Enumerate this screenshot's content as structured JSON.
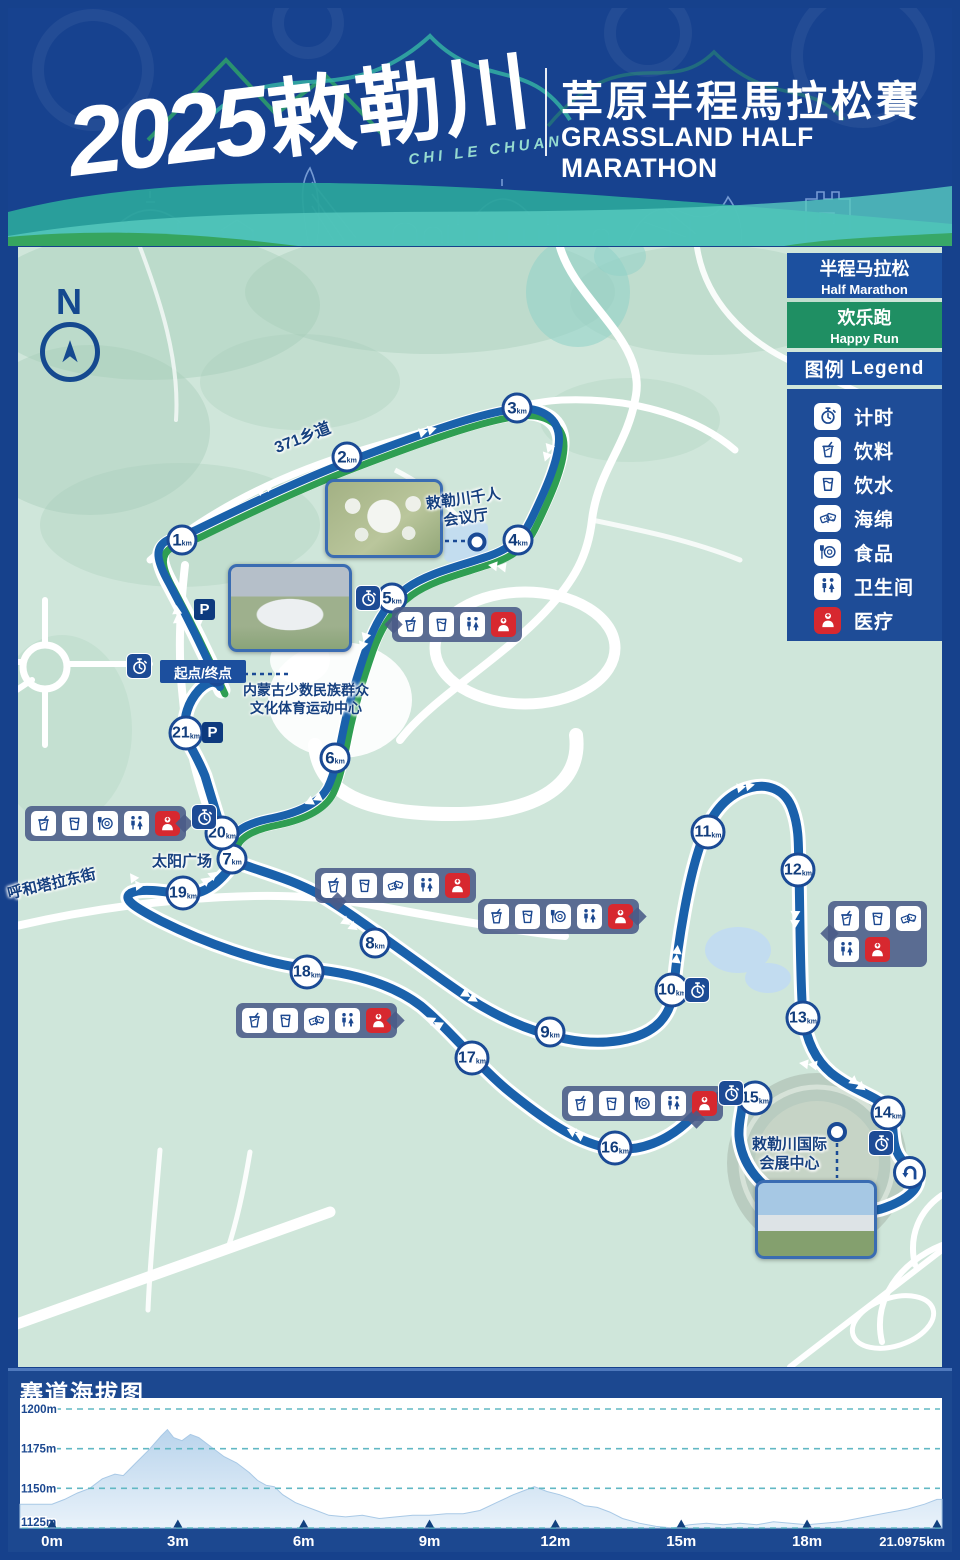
{
  "header": {
    "logo_year": "2025",
    "logo_cn": "敕勒川",
    "logo_pinyin": "CHI LE CHUAN",
    "title_cn": "草原半程馬拉松賽",
    "title_en": "GRASSLAND HALF MARATHON"
  },
  "map": {
    "compass": "N",
    "km_unit": "km",
    "parking_label": "P",
    "start_finish": "起点/终点",
    "routes": {
      "half_marathon_color": "#1a61ab",
      "happy_run_color": "#2f9e52"
    },
    "legend": {
      "half_marathon": {
        "zh": "半程马拉松",
        "en": "Half Marathon",
        "color": "#1c509f"
      },
      "happy_run": {
        "zh": "欢乐跑",
        "en": "Happy Run",
        "color": "#1f8f63"
      },
      "title_zh": "图例",
      "title_en": "Legend",
      "medical_color": "#d7282f",
      "items": [
        {
          "icon": "timer-icon",
          "label": "计时"
        },
        {
          "icon": "drink-icon",
          "label": "饮料"
        },
        {
          "icon": "water-icon",
          "label": "饮水"
        },
        {
          "icon": "sponge-icon",
          "label": "海绵"
        },
        {
          "icon": "food-icon",
          "label": "食品"
        },
        {
          "icon": "toilet-icon",
          "label": "卫生间"
        },
        {
          "icon": "medical-icon",
          "label": "医疗"
        }
      ]
    },
    "labels": [
      {
        "id": "road-371",
        "text": "371乡道",
        "x": 272,
        "y": 440,
        "rot": -21,
        "size": 16
      },
      {
        "id": "qianren-hall",
        "text": "敕勒川千人\n会议厅",
        "x": 425,
        "y": 496,
        "rot": -8,
        "size": 15
      },
      {
        "id": "minority-center",
        "text": "内蒙古少数民族群众\n文化体育运动中心",
        "x": 243,
        "y": 682,
        "rot": 0,
        "size": 14
      },
      {
        "id": "sun-plaza",
        "text": "太阳广场",
        "x": 152,
        "y": 853,
        "rot": 0,
        "size": 15
      },
      {
        "id": "huhetala-street",
        "text": "呼和塔拉东街",
        "x": 6,
        "y": 886,
        "rot": -13,
        "size": 15
      },
      {
        "id": "convention-center",
        "text": "敕勒川国际\n会展中心",
        "x": 752,
        "y": 1136,
        "rot": 0,
        "size": 15
      }
    ],
    "km_markers": [
      {
        "n": 1,
        "x": 182,
        "y": 540
      },
      {
        "n": 2,
        "x": 347,
        "y": 457
      },
      {
        "n": 3,
        "x": 517,
        "y": 408
      },
      {
        "n": 4,
        "x": 518,
        "y": 540
      },
      {
        "n": 5,
        "x": 392,
        "y": 598
      },
      {
        "n": 6,
        "x": 335,
        "y": 758
      },
      {
        "n": 7,
        "x": 232,
        "y": 859
      },
      {
        "n": 8,
        "x": 375,
        "y": 943
      },
      {
        "n": 9,
        "x": 550,
        "y": 1032
      },
      {
        "n": 10,
        "x": 672,
        "y": 990
      },
      {
        "n": 11,
        "x": 708,
        "y": 832
      },
      {
        "n": 12,
        "x": 798,
        "y": 870
      },
      {
        "n": 13,
        "x": 803,
        "y": 1018
      },
      {
        "n": 14,
        "x": 888,
        "y": 1113
      },
      {
        "n": 15,
        "x": 755,
        "y": 1098
      },
      {
        "n": 16,
        "x": 615,
        "y": 1148
      },
      {
        "n": 17,
        "x": 472,
        "y": 1058
      },
      {
        "n": 18,
        "x": 307,
        "y": 972
      },
      {
        "n": 19,
        "x": 183,
        "y": 893
      },
      {
        "n": 20,
        "x": 222,
        "y": 833
      },
      {
        "n": 21,
        "x": 186,
        "y": 733
      }
    ],
    "facility_stations": [
      {
        "x": 392,
        "y": 607,
        "icons": [
          "drink",
          "water",
          "toilet",
          "medical"
        ],
        "pointer": "left",
        "rows": 1
      },
      {
        "x": 25,
        "y": 806,
        "icons": [
          "drink",
          "water",
          "food",
          "toilet",
          "medical"
        ],
        "pointer": "right",
        "rows": 1
      },
      {
        "x": 315,
        "y": 868,
        "icons": [
          "drink",
          "water",
          "sponge",
          "toilet",
          "medical"
        ],
        "pointer": "bottom-left",
        "rows": 1
      },
      {
        "x": 478,
        "y": 899,
        "icons": [
          "drink",
          "water",
          "food",
          "toilet",
          "medical"
        ],
        "pointer": "right",
        "rows": 1
      },
      {
        "x": 236,
        "y": 1003,
        "icons": [
          "drink",
          "water",
          "sponge",
          "toilet",
          "medical"
        ],
        "pointer": "right",
        "rows": 1
      },
      {
        "x": 828,
        "y": 901,
        "icons": [
          "drink",
          "water",
          "sponge",
          "toilet",
          "medical"
        ],
        "pointer": "left",
        "rows": 2
      },
      {
        "x": 562,
        "y": 1086,
        "icons": [
          "drink",
          "water",
          "food",
          "toilet",
          "medical"
        ],
        "pointer": "bottom-right",
        "rows": 1
      }
    ],
    "timing_points": [
      {
        "x": 355,
        "y": 585
      },
      {
        "x": 126,
        "y": 653
      },
      {
        "x": 191,
        "y": 804
      },
      {
        "x": 684,
        "y": 977
      },
      {
        "x": 718,
        "y": 1080
      },
      {
        "x": 868,
        "y": 1130
      }
    ],
    "parking_points": [
      {
        "x": 194,
        "y": 599
      },
      {
        "x": 202,
        "y": 722
      }
    ],
    "uturn": {
      "x": 893,
      "y": 1156
    }
  },
  "elevation": {
    "title": "赛道海拔图"
  },
  "chart_data": {
    "type": "area",
    "title": "赛道海拔图",
    "xlabel": "distance (km)",
    "ylabel": "elevation (m)",
    "ylim": [
      1125,
      1200
    ],
    "yticks": [
      1200,
      1175,
      1150,
      1125
    ],
    "ytick_labels": [
      "1200m",
      "1175m",
      "1150m",
      "1125m"
    ],
    "xticks": [
      0,
      3,
      6,
      9,
      12,
      15,
      18,
      21.0975
    ],
    "xtick_labels": [
      "0m",
      "3m",
      "6m",
      "9m",
      "12m",
      "15m",
      "18m",
      "21.0975km"
    ],
    "x_range": [
      0,
      21.0975
    ],
    "grid": "dashed-horizontal",
    "fill_color": "#c7dcf0",
    "series": [
      {
        "name": "course elevation",
        "x": [
          0,
          0.3,
          0.6,
          0.9,
          1.2,
          1.5,
          1.7,
          2.0,
          2.3,
          2.6,
          2.75,
          2.9,
          3.1,
          3.3,
          3.5,
          3.8,
          4.1,
          4.4,
          4.7,
          4.9,
          5.1,
          5.3,
          5.5,
          5.8,
          6.0,
          6.3,
          6.6,
          7.0,
          7.4,
          7.8,
          8.2,
          8.6,
          9.0,
          9.4,
          9.8,
          10.2,
          10.6,
          11.0,
          11.3,
          11.5,
          11.8,
          12.1,
          12.4,
          12.7,
          13.0,
          13.3,
          13.6,
          14.0,
          14.4,
          14.8,
          15.2,
          15.6,
          16.0,
          16.4,
          16.8,
          17.2,
          17.6,
          18.0,
          18.4,
          18.8,
          19.2,
          19.6,
          20.0,
          20.4,
          20.8,
          21.0975
        ],
        "y": [
          1140,
          1143,
          1147,
          1150,
          1156,
          1159,
          1158,
          1166,
          1174,
          1183,
          1187,
          1182,
          1180,
          1184,
          1182,
          1176,
          1170,
          1166,
          1160,
          1155,
          1152,
          1151,
          1146,
          1141,
          1139,
          1136,
          1133,
          1132,
          1133,
          1131,
          1132,
          1133,
          1133,
          1134,
          1134,
          1136,
          1141,
          1146,
          1149,
          1151,
          1148,
          1146,
          1143,
          1139,
          1138,
          1135,
          1131,
          1128,
          1126,
          1125,
          1127,
          1128,
          1127,
          1128,
          1127,
          1129,
          1128,
          1127,
          1128,
          1129,
          1131,
          1133,
          1135,
          1137,
          1140,
          1143
        ]
      }
    ]
  }
}
